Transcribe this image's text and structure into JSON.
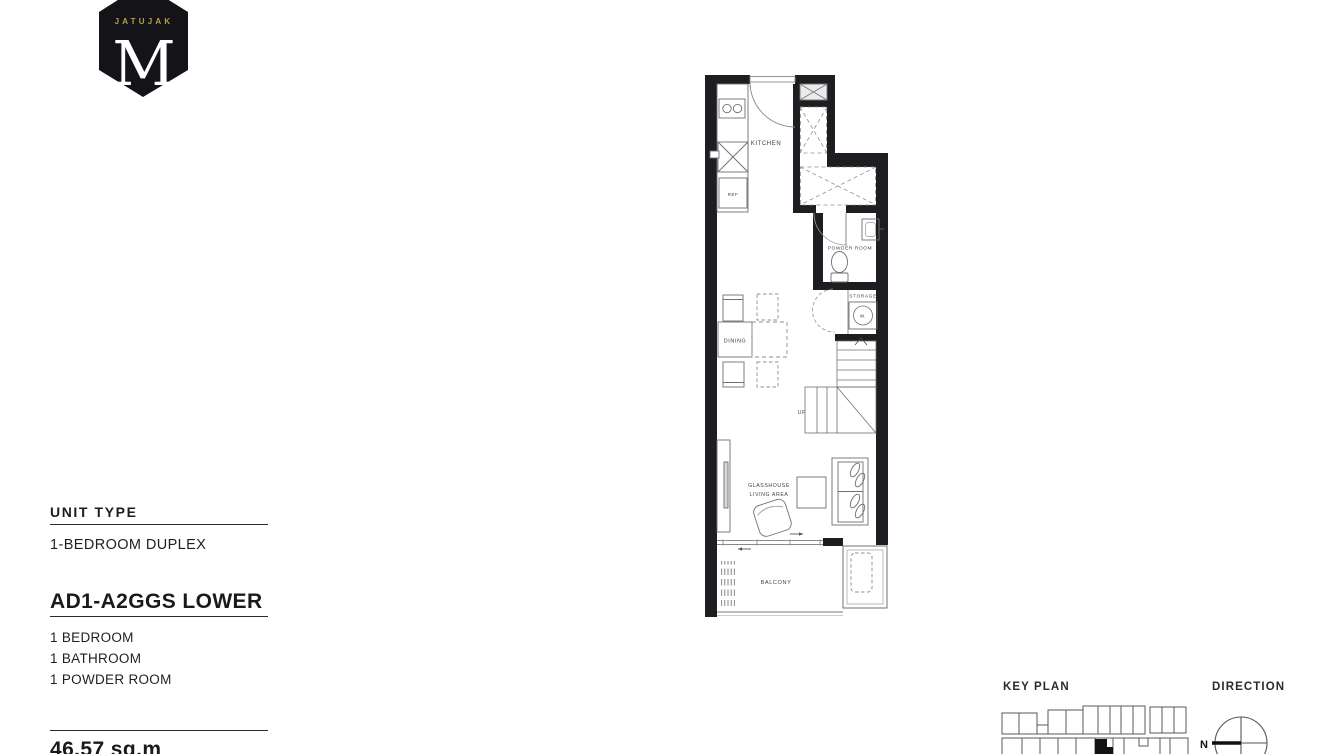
{
  "logo": {
    "project": "JATUJAK",
    "monogram": "M"
  },
  "info": {
    "section_title": "UNIT TYPE",
    "unit_type": "1-BEDROOM DUPLEX",
    "unit_code": "AD1-A2GGS LOWER",
    "features": [
      "1 BEDROOM",
      "1 BATHROOM",
      "1 POWDER ROOM"
    ],
    "area": "46.57 sq.m"
  },
  "plan": {
    "labels": {
      "kitchen": "KITCHEN",
      "ref": "REF",
      "powder_room": "POWDER ROOM",
      "storage": "STORAGE",
      "washer": "W.",
      "dining": "DINING",
      "up": "UP",
      "glasshouse_line1": "GLASSHOUSE",
      "glasshouse_line2": "LIVING AREA",
      "balcony": "BALCONY"
    }
  },
  "footer": {
    "key_plan_label": "KEY PLAN",
    "direction_label": "DIRECTION",
    "north": "N"
  },
  "colors": {
    "wall": "#1e1e22",
    "gold": "#bd9b4d",
    "logo_bg": "#141418"
  }
}
